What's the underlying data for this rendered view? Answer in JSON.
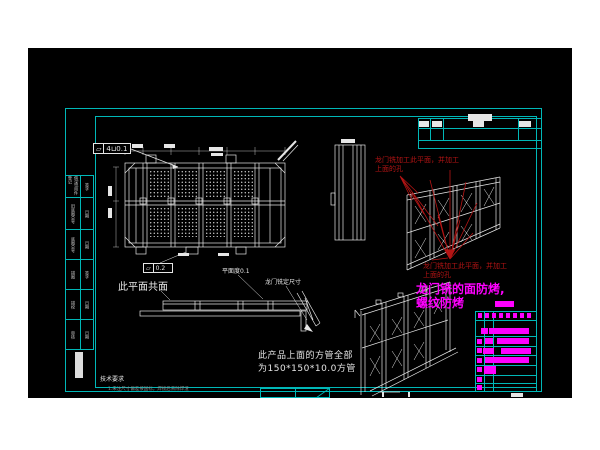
{
  "colors": {
    "page_bg": "#ffffff",
    "canvas_bg": "#000000",
    "frame_cyan": "#00b8b8",
    "drawing_white": "#e6e6e6",
    "annotation_red": "#b41414",
    "annotation_magenta": "#ff00ff",
    "note_gray": "#8a8a8a"
  },
  "annotations": {
    "gdt1": {
      "symbol": "▱",
      "value": "4⊔0.1"
    },
    "gdt2": {
      "symbol": "▱",
      "value": "0.2"
    },
    "coplanar_label": "此平面共面",
    "flatness_label": "平面度0.1",
    "gantry_dim_label": "龙门铣定尺寸",
    "red_note_line1": "龙门铣加工此平面，并加工",
    "red_note_line2": "上面的孔",
    "magenta_note_line1": "龙门铣的面防烤,",
    "magenta_note_line2": "螺纹防烤",
    "square_tube_note_line1": "此产品上面的方管全部",
    "square_tube_note_line2": "为150*150*10.0方管",
    "tech_req_title": "技术要求",
    "tech_req_note": "1.未注尺寸偏差按国标，焊接后去除焊渣"
  },
  "left_strip": {
    "cells": [
      {
        "main": "借(通)用件登记",
        "sub": "签字"
      },
      {
        "main": "旧底图总号",
        "sub": "日期"
      },
      {
        "main": "底图总号",
        "sub": "日期"
      },
      {
        "main": "描图",
        "sub": "签字"
      },
      {
        "main": "描校",
        "sub": "日期"
      },
      {
        "main": "审核",
        "sub": "日期"
      }
    ]
  },
  "blocks": [
    {
      "n": "rev-entry",
      "x": 440,
      "y": 66,
      "w": 24,
      "h": 7,
      "c": "#e6e6e6"
    },
    {
      "n": "rev-entry",
      "x": 391,
      "y": 73,
      "w": 10,
      "h": 6,
      "c": "#e6e6e6"
    },
    {
      "n": "rev-entry",
      "x": 404,
      "y": 73,
      "w": 10,
      "h": 6,
      "c": "#e6e6e6"
    },
    {
      "n": "rev-entry",
      "x": 445,
      "y": 73,
      "w": 11,
      "h": 6,
      "c": "#e6e6e6"
    },
    {
      "n": "rev-entry",
      "x": 491,
      "y": 73,
      "w": 12,
      "h": 6,
      "c": "#e6e6e6"
    },
    {
      "n": "dim-text",
      "x": 104,
      "y": 96,
      "w": 11,
      "h": 4,
      "c": "#e6e6e6"
    },
    {
      "n": "dim-text",
      "x": 136,
      "y": 96,
      "w": 11,
      "h": 4,
      "c": "#e6e6e6"
    },
    {
      "n": "dim-text",
      "x": 181,
      "y": 99,
      "w": 14,
      "h": 4,
      "c": "#e6e6e6"
    },
    {
      "n": "dim-text",
      "x": 183,
      "y": 105,
      "w": 12,
      "h": 3,
      "c": "#e6e6e6"
    },
    {
      "n": "dim-text",
      "x": 80,
      "y": 138,
      "w": 4,
      "h": 10,
      "c": "#e6e6e6"
    },
    {
      "n": "dim-text",
      "x": 80,
      "y": 160,
      "w": 4,
      "h": 10,
      "c": "#e6e6e6"
    },
    {
      "n": "dim-text",
      "x": 313,
      "y": 91,
      "w": 14,
      "h": 4,
      "c": "#e6e6e6"
    },
    {
      "n": "dim-text",
      "x": 150,
      "y": 205,
      "w": 11,
      "h": 3,
      "c": "#e6e6e6"
    },
    {
      "n": "dim-text",
      "x": 190,
      "y": 205,
      "w": 11,
      "h": 3,
      "c": "#e6e6e6"
    },
    {
      "n": "sheet-note",
      "x": 483,
      "y": 345,
      "w": 12,
      "h": 4,
      "c": "#e6e6e6"
    },
    {
      "n": "fold-mark",
      "x": 354,
      "y": 344,
      "w": 2,
      "h": 5,
      "c": "#e6e6e6"
    },
    {
      "n": "fold-mark",
      "x": 380,
      "y": 344,
      "w": 2,
      "h": 5,
      "c": "#e6e6e6"
    },
    {
      "n": "strip-box",
      "x": 47,
      "y": 304,
      "w": 8,
      "h": 26,
      "c": "#dddddd"
    },
    {
      "n": "magenta-block",
      "x": 467,
      "y": 253,
      "w": 19,
      "h": 6,
      "c": "#ff00ff"
    },
    {
      "n": "bom-header-glyph",
      "x": 450,
      "y": 265,
      "w": 4,
      "h": 5,
      "c": "#ff00ff"
    },
    {
      "n": "bom-header-glyph",
      "x": 457,
      "y": 265,
      "w": 4,
      "h": 5,
      "c": "#ff00ff"
    },
    {
      "n": "bom-header-glyph",
      "x": 464,
      "y": 265,
      "w": 4,
      "h": 5,
      "c": "#ff00ff"
    },
    {
      "n": "bom-header-glyph",
      "x": 471,
      "y": 265,
      "w": 4,
      "h": 5,
      "c": "#ff00ff"
    },
    {
      "n": "bom-header-glyph",
      "x": 478,
      "y": 265,
      "w": 4,
      "h": 5,
      "c": "#ff00ff"
    },
    {
      "n": "bom-header-glyph",
      "x": 485,
      "y": 265,
      "w": 4,
      "h": 5,
      "c": "#ff00ff"
    },
    {
      "n": "bom-header-glyph",
      "x": 492,
      "y": 265,
      "w": 4,
      "h": 5,
      "c": "#ff00ff"
    },
    {
      "n": "bom-header-glyph",
      "x": 499,
      "y": 265,
      "w": 4,
      "h": 5,
      "c": "#ff00ff"
    },
    {
      "n": "bom-bar",
      "x": 453,
      "y": 280,
      "w": 7,
      "h": 6,
      "c": "#ff00ff"
    },
    {
      "n": "bom-bar",
      "x": 461,
      "y": 280,
      "w": 40,
      "h": 6,
      "c": "#ff00ff"
    },
    {
      "n": "bom-bar",
      "x": 449,
      "y": 291,
      "w": 5,
      "h": 5,
      "c": "#ff00ff"
    },
    {
      "n": "bom-bar",
      "x": 457,
      "y": 290,
      "w": 8,
      "h": 6,
      "c": "#ff00ff"
    },
    {
      "n": "bom-bar",
      "x": 469,
      "y": 290,
      "w": 32,
      "h": 6,
      "c": "#ff00ff"
    },
    {
      "n": "bom-bar",
      "x": 449,
      "y": 300,
      "w": 5,
      "h": 5,
      "c": "#ff00ff"
    },
    {
      "n": "bom-bar",
      "x": 455,
      "y": 300,
      "w": 11,
      "h": 6,
      "c": "#ff00ff"
    },
    {
      "n": "bom-bar",
      "x": 473,
      "y": 300,
      "w": 30,
      "h": 6,
      "c": "#ff00ff"
    },
    {
      "n": "bom-bar",
      "x": 449,
      "y": 310,
      "w": 5,
      "h": 5,
      "c": "#ff00ff"
    },
    {
      "n": "bom-bar",
      "x": 457,
      "y": 309,
      "w": 44,
      "h": 6,
      "c": "#ff00ff"
    },
    {
      "n": "bom-bar",
      "x": 449,
      "y": 319,
      "w": 5,
      "h": 5,
      "c": "#ff00ff"
    },
    {
      "n": "bom-bar",
      "x": 456,
      "y": 318,
      "w": 12,
      "h": 8,
      "c": "#ff00ff"
    },
    {
      "n": "bom-bar",
      "x": 449,
      "y": 329,
      "w": 5,
      "h": 5,
      "c": "#ff00ff"
    },
    {
      "n": "bom-bar",
      "x": 449,
      "y": 337,
      "w": 5,
      "h": 5,
      "c": "#ff00ff"
    }
  ]
}
